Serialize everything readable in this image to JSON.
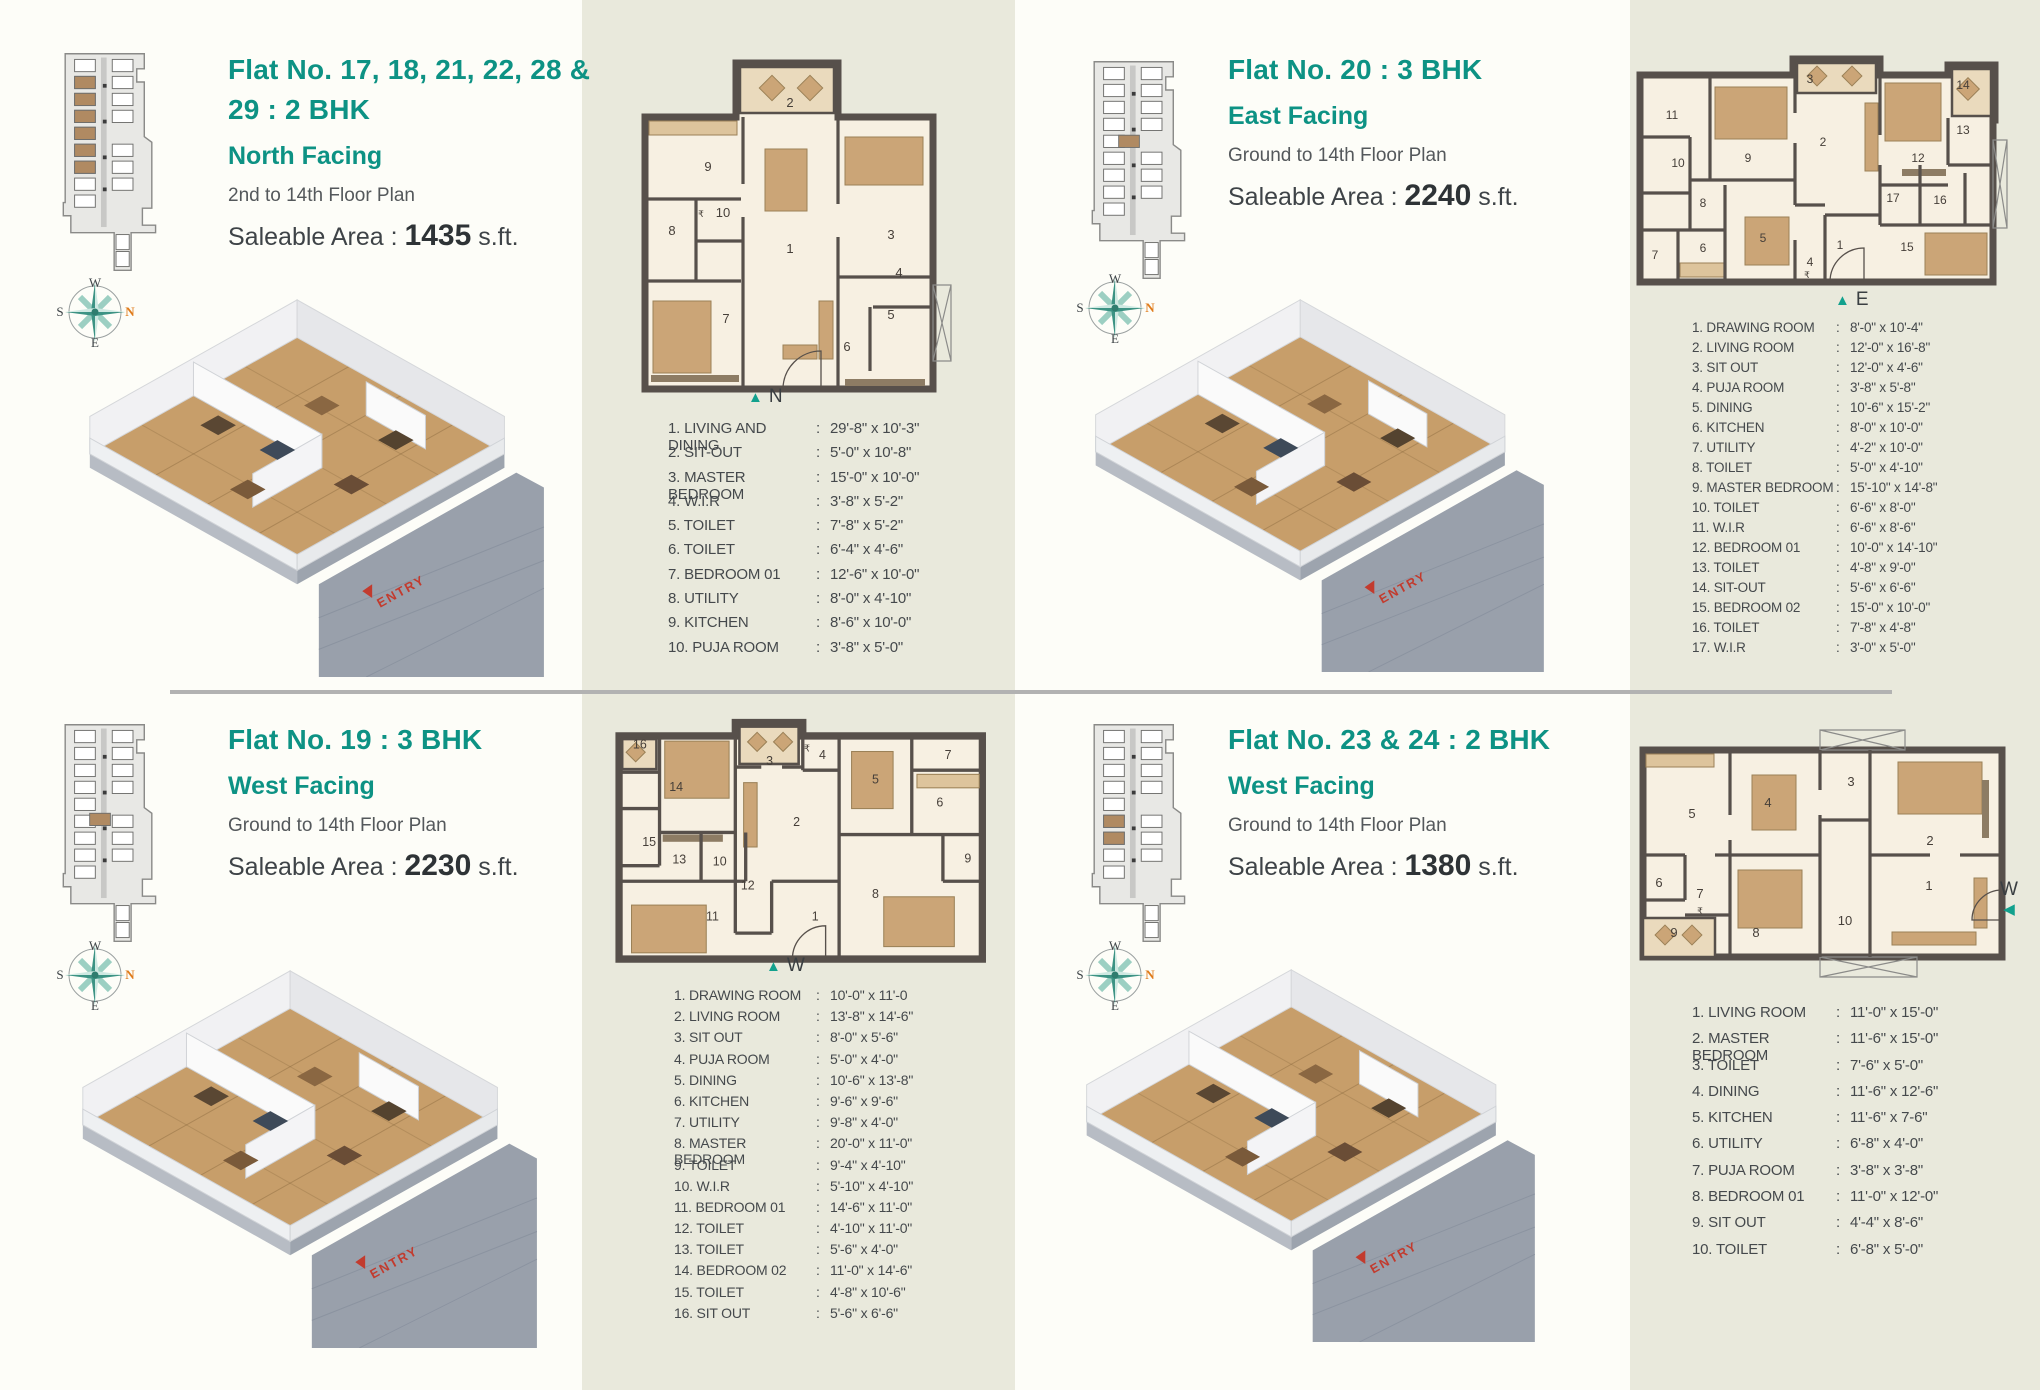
{
  "palette": {
    "accent_teal": "#0d9284",
    "accent_orange": "#e07c1c",
    "panel_beige": "#e9e9dc",
    "panel_white": "#fdfdf8",
    "wall": "#57504b"
  },
  "list_separator": ":",
  "compass": {
    "top": "W",
    "left": "S",
    "right": "N",
    "bottom": "E"
  },
  "quadrants": [
    {
      "section": "flat-17-18-21-22-28-29",
      "title": "Flat No. 17, 18, 21, 22, 28 & 29 : 2 BHK",
      "facing": "North Facing",
      "floor_range": "2nd to 14th Floor Plan",
      "area_label": "Saleable Area :",
      "area_value": "1435",
      "area_unit": "s.ft.",
      "entry_label": "ENTRY",
      "marker": {
        "arrow": "▲",
        "letter": "N"
      },
      "rooms": [
        {
          "label": "1. LIVING AND DINING",
          "dim": "29'-8\" x 10'-3\""
        },
        {
          "label": "2. SIT-OUT",
          "dim": "5'-0\" x 10'-8\""
        },
        {
          "label": "3. MASTER BEDROOM",
          "dim": "15'-0\" x 10'-0\""
        },
        {
          "label": "4. W.I.R",
          "dim": "3'-8\" x 5'-2\""
        },
        {
          "label": "5. TOILET",
          "dim": "7'-8\" x 5'-2\""
        },
        {
          "label": "6. TOILET",
          "dim": "6'-4\" x 4'-6\""
        },
        {
          "label": "7. BEDROOM 01",
          "dim": "12'-6\" x 10'-0\""
        },
        {
          "label": "8. UTILITY",
          "dim": "8'-0\" x 4'-10\""
        },
        {
          "label": "9. KITCHEN",
          "dim": "8'-6\" x 10'-0\""
        },
        {
          "label": "10. PUJA ROOM",
          "dim": "3'-8\" x 5'-0\""
        }
      ],
      "plan_labels": [
        {
          "t": "2",
          "x": 157,
          "y": 58
        },
        {
          "t": "9",
          "x": 75,
          "y": 122
        },
        {
          "t": "₹",
          "x": 68,
          "y": 168
        },
        {
          "t": "10",
          "x": 90,
          "y": 168
        },
        {
          "t": "8",
          "x": 39,
          "y": 186
        },
        {
          "t": "1",
          "x": 157,
          "y": 204
        },
        {
          "t": "7",
          "x": 93,
          "y": 274
        },
        {
          "t": "3",
          "x": 258,
          "y": 190
        },
        {
          "t": "4",
          "x": 266,
          "y": 228
        },
        {
          "t": "5",
          "x": 258,
          "y": 270
        },
        {
          "t": "6",
          "x": 214,
          "y": 302
        }
      ]
    },
    {
      "section": "flat-20",
      "title": "Flat No. 20 : 3 BHK",
      "facing": "East Facing",
      "floor_range": "Ground to 14th Floor Plan",
      "area_label": "Saleable Area :",
      "area_value": "2240",
      "area_unit": "s.ft.",
      "entry_label": "ENTRY",
      "marker": {
        "arrow": "▲",
        "letter": "E"
      },
      "rooms": [
        {
          "label": "1. DRAWING ROOM",
          "dim": "8'-0\" x 10'-4\""
        },
        {
          "label": "2. LIVING ROOM",
          "dim": "12'-0\" x 16'-8\""
        },
        {
          "label": "3. SIT OUT",
          "dim": "12'-0\" x 4'-6\""
        },
        {
          "label": "4. PUJA ROOM",
          "dim": "3'-8\" x 5'-8\""
        },
        {
          "label": "5. DINING",
          "dim": "10'-6\" x 15'-2\""
        },
        {
          "label": "6. KITCHEN",
          "dim": "8'-0\" x 10'-0\""
        },
        {
          "label": "7. UTILITY",
          "dim": "4'-2\" x 10'-0\""
        },
        {
          "label": "8. TOILET",
          "dim": "5'-0\" x 4'-10\""
        },
        {
          "label": "9. MASTER BEDROOM",
          "dim": "15'-10\" x 14'-8\""
        },
        {
          "label": "10. TOILET",
          "dim": "6'-6\" x 8'-0\""
        },
        {
          "label": "11. W.I.R",
          "dim": "6'-6\" x 8'-6\""
        },
        {
          "label": "12. BEDROOM 01",
          "dim": "10'-0\" x 14'-10\""
        },
        {
          "label": "13. TOILET",
          "dim": "4'-8\" x 9'-0\""
        },
        {
          "label": "14. SIT-OUT",
          "dim": "5'-6\" x 6'-6\""
        },
        {
          "label": "15. BEDROOM 02",
          "dim": "15'-0\" x 10'-0\""
        },
        {
          "label": "16. TOILET",
          "dim": "7'-8\" x 4'-8\""
        },
        {
          "label": "17. W.I.R",
          "dim": "3'-0\" x 5'-0\""
        }
      ],
      "plan_labels": [
        {
          "t": "11",
          "x": 42,
          "y": 74
        },
        {
          "t": "9",
          "x": 118,
          "y": 117
        },
        {
          "t": "3",
          "x": 180,
          "y": 38
        },
        {
          "t": "2",
          "x": 193,
          "y": 101
        },
        {
          "t": "12",
          "x": 288,
          "y": 117
        },
        {
          "t": "14",
          "x": 333,
          "y": 44
        },
        {
          "t": "13",
          "x": 333,
          "y": 89
        },
        {
          "t": "10",
          "x": 48,
          "y": 122
        },
        {
          "t": "8",
          "x": 73,
          "y": 162
        },
        {
          "t": "7",
          "x": 25,
          "y": 214
        },
        {
          "t": "6",
          "x": 73,
          "y": 207
        },
        {
          "t": "5",
          "x": 133,
          "y": 197
        },
        {
          "t": "4",
          "x": 180,
          "y": 221
        },
        {
          "t": "₹",
          "x": 177,
          "y": 233
        },
        {
          "t": "1",
          "x": 210,
          "y": 204
        },
        {
          "t": "17",
          "x": 263,
          "y": 157
        },
        {
          "t": "16",
          "x": 310,
          "y": 159
        },
        {
          "t": "15",
          "x": 277,
          "y": 206
        }
      ]
    },
    {
      "section": "flat-19",
      "title": "Flat No. 19 : 3 BHK",
      "facing": "West Facing",
      "floor_range": "Ground to 14th Floor Plan",
      "area_label": "Saleable Area :",
      "area_value": "2230",
      "area_unit": "s.ft.",
      "entry_label": "ENTRY",
      "marker": {
        "arrow": "▲",
        "letter": "W"
      },
      "rooms": [
        {
          "label": "1. DRAWING ROOM",
          "dim": "10'-0\" x 11'-0"
        },
        {
          "label": "2. LIVING ROOM",
          "dim": "13'-8\" x 14'-6\""
        },
        {
          "label": "3. SIT OUT",
          "dim": "8'-0\" x 5'-6\""
        },
        {
          "label": "4. PUJA ROOM",
          "dim": "5'-0\" x 4'-0\""
        },
        {
          "label": "5. DINING",
          "dim": "10'-6\" x 13'-8\""
        },
        {
          "label": "6. KITCHEN",
          "dim": "9'-6\" x 9'-6\""
        },
        {
          "label": "7. UTILITY",
          "dim": "9'-8\" x 4'-0\""
        },
        {
          "label": "8. MASTER BEDROOM",
          "dim": "20'-0\" x 11'-0\""
        },
        {
          "label": "9. TOILET",
          "dim": "9'-4\" x 4'-10\""
        },
        {
          "label": "10. W.I.R",
          "dim": "5'-10\" x 4'-10\""
        },
        {
          "label": "11. BEDROOM 01",
          "dim": "14'-6\" x 11'-0\""
        },
        {
          "label": "12. TOILET",
          "dim": "4'-10\" x 11'-0\""
        },
        {
          "label": "13. TOILET",
          "dim": "5'-6\" x 4'-0\""
        },
        {
          "label": "14. BEDROOM 02",
          "dim": "11'-0\" x 14'-6\""
        },
        {
          "label": "15. TOILET",
          "dim": "4'-8\" x 10'-6\""
        },
        {
          "label": "16. SIT OUT",
          "dim": "5'-6\" x 6'-6\""
        }
      ],
      "plan_labels": [
        {
          "t": "16",
          "x": 48,
          "y": 37
        },
        {
          "t": "14",
          "x": 83,
          "y": 78
        },
        {
          "t": "3",
          "x": 173,
          "y": 53
        },
        {
          "t": "₹",
          "x": 209,
          "y": 40
        },
        {
          "t": "4",
          "x": 224,
          "y": 47
        },
        {
          "t": "5",
          "x": 275,
          "y": 71
        },
        {
          "t": "7",
          "x": 345,
          "y": 47
        },
        {
          "t": "6",
          "x": 337,
          "y": 93
        },
        {
          "t": "2",
          "x": 199,
          "y": 112
        },
        {
          "t": "15",
          "x": 57,
          "y": 131
        },
        {
          "t": "13",
          "x": 86,
          "y": 148
        },
        {
          "t": "10",
          "x": 125,
          "y": 150
        },
        {
          "t": "12",
          "x": 152,
          "y": 173
        },
        {
          "t": "11",
          "x": 118,
          "y": 203
        },
        {
          "t": "1",
          "x": 217,
          "y": 203
        },
        {
          "t": "8",
          "x": 275,
          "y": 181
        },
        {
          "t": "9",
          "x": 364,
          "y": 147
        }
      ]
    },
    {
      "section": "flat-23-24",
      "title": "Flat No. 23 & 24 : 2 BHK",
      "facing": "West Facing",
      "floor_range": "Ground to 14th Floor Plan",
      "area_label": "Saleable Area :",
      "area_value": "1380",
      "area_unit": "s.ft.",
      "entry_label": "ENTRY",
      "marker": {
        "arrow": "◀",
        "letter": "W"
      },
      "rooms": [
        {
          "label": "1. LIVING ROOM",
          "dim": "11'-0\" x 15'-0\""
        },
        {
          "label": "2. MASTER BEDROOM",
          "dim": "11'-6\" x 15'-0\""
        },
        {
          "label": "3. TOILET",
          "dim": "7'-6\" x 5'-0\""
        },
        {
          "label": "4. DINING",
          "dim": "11'-6\" x 12'-6\""
        },
        {
          "label": "5. KITCHEN",
          "dim": "11'-6\" x 7-6\""
        },
        {
          "label": "6. UTILITY",
          "dim": "6'-8\" x 4'-0\""
        },
        {
          "label": "7. PUJA ROOM",
          "dim": "3'-8\" x 3'-8\""
        },
        {
          "label": "8. BEDROOM 01",
          "dim": "11'-0\" x 12'-0\""
        },
        {
          "label": "9. SIT OUT",
          "dim": "4'-4\" x 8'-6\""
        },
        {
          "label": "10. TOILET",
          "dim": "6'-8\" x 5'-0\""
        }
      ],
      "plan_labels": [
        {
          "t": "5",
          "x": 62,
          "y": 98
        },
        {
          "t": "4",
          "x": 138,
          "y": 87
        },
        {
          "t": "3",
          "x": 221,
          "y": 66
        },
        {
          "t": "2",
          "x": 300,
          "y": 125
        },
        {
          "t": "1",
          "x": 299,
          "y": 170
        },
        {
          "t": "6",
          "x": 29,
          "y": 167
        },
        {
          "t": "7",
          "x": 70,
          "y": 178
        },
        {
          "t": "₹",
          "x": 70,
          "y": 194
        },
        {
          "t": "9",
          "x": 44,
          "y": 217
        },
        {
          "t": "8",
          "x": 126,
          "y": 217
        },
        {
          "t": "10",
          "x": 215,
          "y": 205
        }
      ]
    }
  ]
}
